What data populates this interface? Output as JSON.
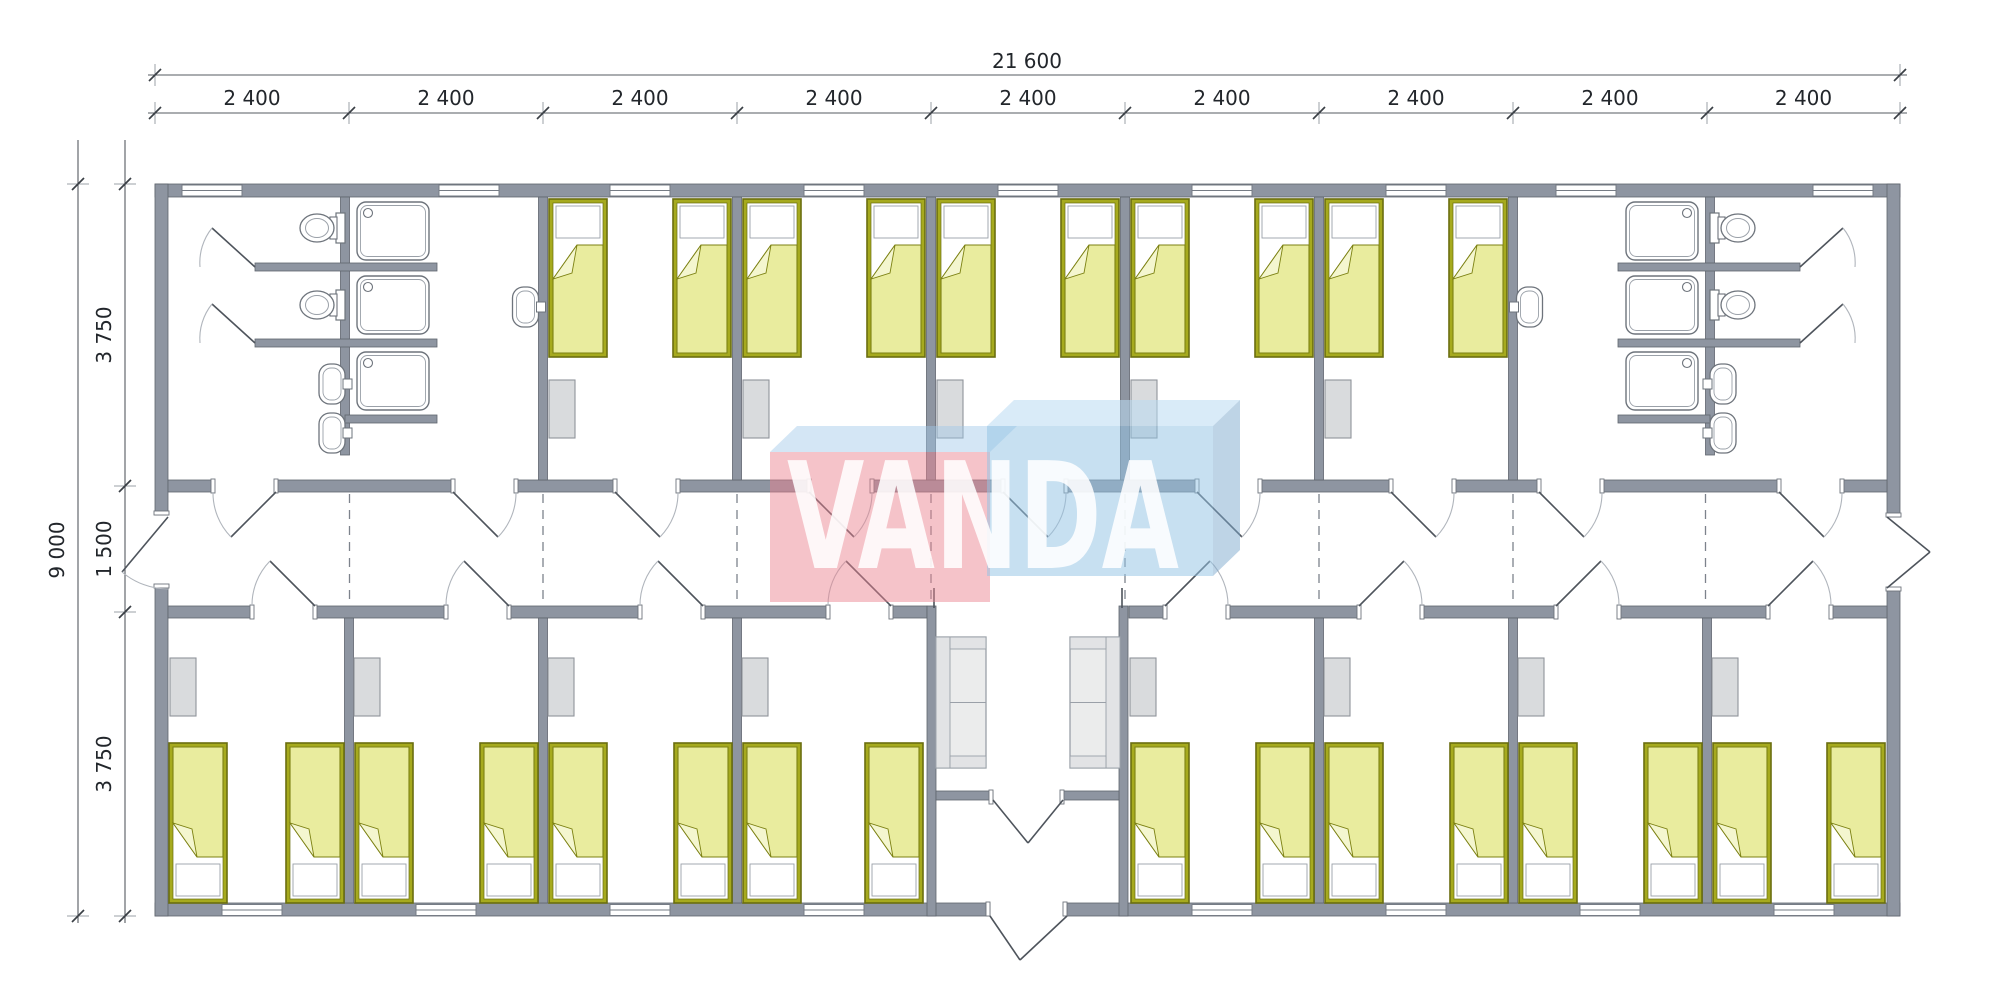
{
  "drawing": {
    "kind": "modular building floor plan",
    "watermark": {
      "text": "VANDA",
      "pink_front": "rgba(234,130,142,0.48)",
      "pink_top": "rgba(160,200,232,0.45)",
      "blue_front": "rgba(148,195,228,0.52)",
      "blue_top": "rgba(185,218,242,0.55)",
      "blue_side": "rgba(125,170,205,0.50)",
      "text_color": "rgba(255,255,255,0.87)"
    },
    "dimensions": {
      "overall_width": "21 600",
      "overall_height": "9 000",
      "bay_widths": [
        "2 400",
        "2 400",
        "2 400",
        "2 400",
        "2 400",
        "2 400",
        "2 400",
        "2 400",
        "2 400"
      ],
      "height_segments": [
        "3 750",
        "1 500",
        "3 750"
      ]
    },
    "fixtures_visible": {
      "beds": 26,
      "wardrobes": 13,
      "sofas": 2,
      "toilets": 4,
      "showers": 6,
      "washbasins": 6
    },
    "colors": {
      "wall": "#8e95a1",
      "wall_stroke": "#5f656e",
      "floor": "#ffffff",
      "bed_frame": "#a6aa1e",
      "bed_frame_stroke": "#6a6e10",
      "bed_blanket": "#e9ec9e",
      "bed_blanket_stroke": "#7c8113",
      "bed_fold": "#f4f6cf",
      "cabinet": "#d9dbdd",
      "cabinet_stroke": "#8f949b",
      "sofa": "#ebecec",
      "sofa_inner": "#e2e3e5",
      "sofa_stroke": "#9aa0a8",
      "fixture_stroke": "#6e747c",
      "fixture_inner": "#9aa0a8",
      "door_leaf": "#4e545c",
      "door_arc": "#b0b5bc",
      "dash_line": "#7d838c",
      "dim_line": "#565b62",
      "dim_guide": "#9ba0a7",
      "dim_text": "#22262b",
      "window_stroke": "#767c85"
    }
  }
}
